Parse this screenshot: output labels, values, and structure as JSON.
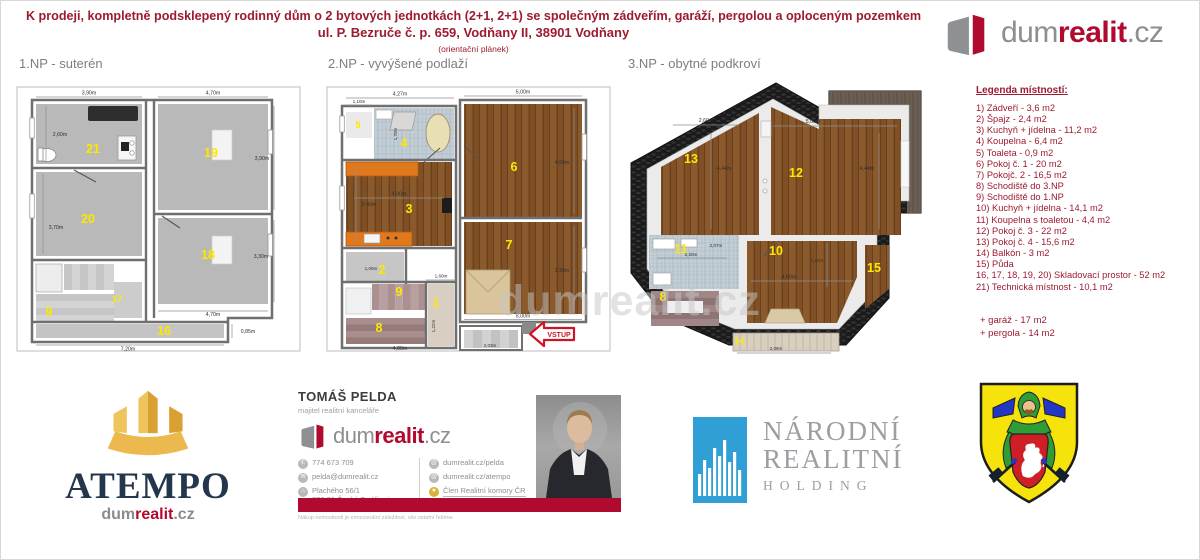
{
  "header": {
    "line1": "K prodeji, kompletně podsklepený rodinný dům o 2 bytových jednotkách (2+1, 2+1) se společným zádveřím, garáží, pergolou a oploceným pozemkem",
    "line2": "ul. P. Bezruče č. p. 659, Vodňany II, 38901 Vodňany",
    "line3": "(orientační plánek)"
  },
  "brand": {
    "dum": "dum",
    "realit": "realit",
    "cz": ".cz"
  },
  "watermark": "dumrealit.cz",
  "plan1": {
    "title": "1.NP - suterén",
    "rooms": {
      "r21": "21",
      "r19": "19",
      "r20": "20",
      "r18": "18",
      "r9": "9",
      "r17": "17",
      "r16": "16"
    },
    "dims": {
      "top_left": "3,90m",
      "top_right": "4,70m",
      "r21_h": "2,60m",
      "r20_h": "3,70m",
      "r19_h": "3,90m",
      "r18_h": "3,30m",
      "r18_w": "4,70m",
      "bottom": "7,20m",
      "corridor": "0,85m"
    }
  },
  "plan2": {
    "title": "2.NP - vyvýšené podlaží",
    "rooms": {
      "r5": "5",
      "r4": "4",
      "r3": "3",
      "r2": "2",
      "r9": "9",
      "r1": "1",
      "r8": "8",
      "r6": "6",
      "r7": "7"
    },
    "dims": {
      "top_left": "4,27m",
      "top_small": "1,10m",
      "r4_h": "1,70m",
      "top_right": "5,00m",
      "r3_w": "4,00m",
      "r3_h": "3,40m",
      "r6_h": "4,00m",
      "r2_w": "1,00m",
      "r1_w": "1,60m",
      "r1_h": "1,22m",
      "r7_h": "3,30m",
      "bottom_right": "5,00m",
      "bottom_left": "4,00m",
      "entry": "2,03m"
    },
    "entry_label": "VSTUP"
  },
  "plan3": {
    "title": "3.NP - obytné podkroví",
    "rooms": {
      "r13": "13",
      "r12": "12",
      "r11": "11",
      "r10": "10",
      "r15": "15",
      "r8": "8",
      "r14": "14"
    },
    "dims": {
      "r13_w": "2,60m",
      "r12_w": "5,00m",
      "left_h": "4,44m",
      "right_h": "4,44m",
      "r11_h": "2,07m",
      "r11_w": "2,20m",
      "r10_h": "1,10m",
      "r10_w": "4,60m",
      "balcony_w": "2,06m"
    }
  },
  "legend": {
    "title": "Legenda místností:",
    "items": [
      "1) Zádveří - 3,6 m2",
      "2) Špajz - 2,4 m2",
      "3) Kuchyň + jídelna - 11,2 m2",
      "4) Koupelna - 6,4 m2",
      "5) Toaleta - 0,9 m2",
      "6) Pokoj č. 1 - 20 m2",
      "7) Pokojč. 2 - 16,5 m2",
      "8) Schodiště do 3.NP",
      "9) Schodiště do 1.NP",
      "10) Kuchyň + jídelna - 14,1 m2",
      "11) Koupelna s toaletou - 4,4 m2",
      "12) Pokoj č. 3 - 22 m2",
      "13) Pokoj č. 4 - 15,6 m2",
      "14) Balkón - 3 m2",
      "15) Půda",
      "16, 17, 18, 19, 20) Skladovací prostor - 52 m2",
      "21) Technická místnost - 10,1 m2"
    ],
    "extras": [
      "+ garáž - 17 m2",
      "+ pergola - 14 m2"
    ]
  },
  "footer": {
    "atempo": {
      "name": "ATEMPO"
    },
    "agent": {
      "name": "TOMÁŠ PELDA",
      "role": "majitel realitní kanceláře",
      "phone": "774 673 709",
      "email": "pelda@dumrealit.cz",
      "addr1": "Plachého 56/1",
      "addr2": "370 01 České Budějovice",
      "web1": "dumrealit.cz/pelda",
      "web2": "dumrealit.cz/atempo",
      "member": "Člen Realitní komory ČR",
      "slogan": "Nákup nemovitosti je emocionální záležitost, vše ostatní řešíme.",
      "icons": {
        "phone": "✆",
        "email": "✉",
        "address": "⌂",
        "web": "@",
        "member": "★"
      }
    },
    "nrh": {
      "l1": "NÁRODNÍ",
      "l2": "REALITNÍ",
      "l3": "HOLDING"
    }
  }
}
